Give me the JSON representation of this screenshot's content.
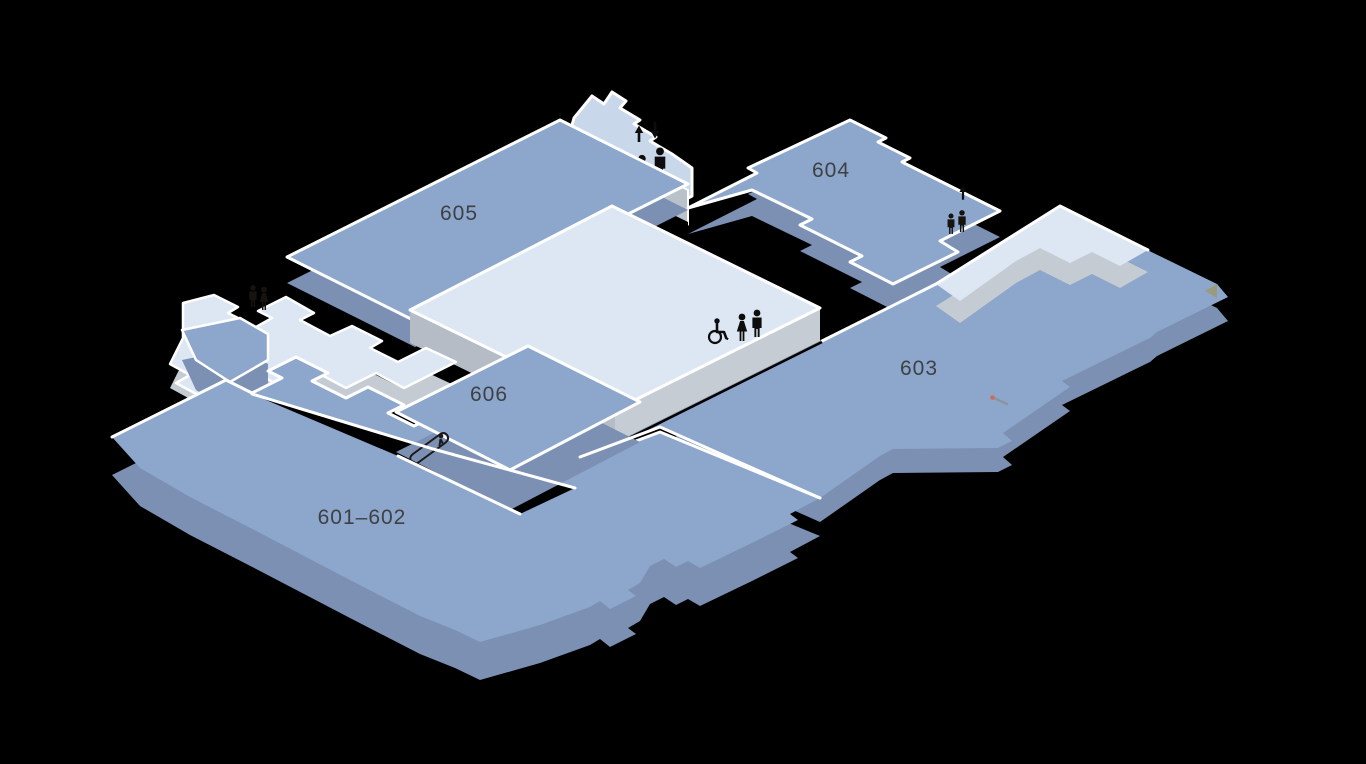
{
  "floorplan": {
    "kind": "isometric-building-floor-map",
    "rooms": [
      {
        "id": "room-601-602",
        "label": "601–602"
      },
      {
        "id": "room-603",
        "label": "603"
      },
      {
        "id": "room-604",
        "label": "604"
      },
      {
        "id": "room-605",
        "label": "605"
      },
      {
        "id": "room-606",
        "label": "606"
      }
    ],
    "icons": [
      {
        "name": "elevator-updown-arrows-icon"
      },
      {
        "name": "elevator-people-icon"
      },
      {
        "name": "wheelchair-icon"
      },
      {
        "name": "restroom-woman-icon"
      },
      {
        "name": "restroom-man-icon"
      },
      {
        "name": "escalator-icon"
      },
      {
        "name": "elevator-up-arrow-icon"
      },
      {
        "name": "pointer-marker-icon"
      }
    ],
    "colors": {
      "background": "#000000",
      "room_top": "#8da6cb",
      "room_side": "#7b90b2",
      "light_floor": "#dde7f3",
      "light_floor_side": "#c5cbd3",
      "elevator_strip": "#b9c1ca",
      "back_wall": "#c9d7ea",
      "outline": "#ffffff",
      "label_text": "#3e4144",
      "icon": "#0d0d0d",
      "marker_red": "#c4705d",
      "marker_gray": "#8f9499"
    }
  }
}
